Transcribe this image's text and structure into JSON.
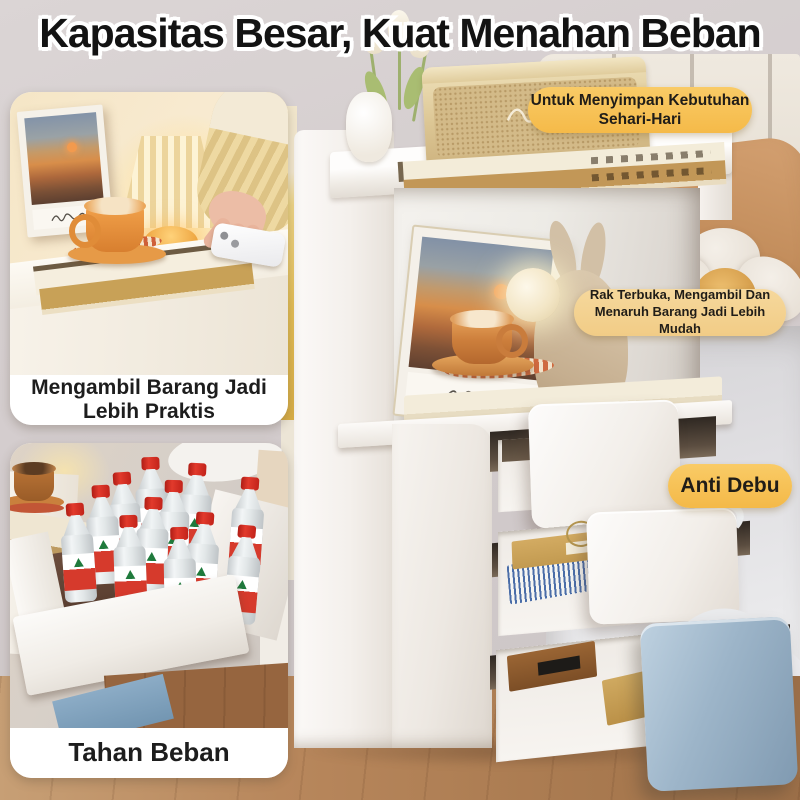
{
  "title": "Kapasitas Besar, Kuat Menahan Beban",
  "badges": {
    "daily": {
      "line1": "Untuk Menyimpan Kebutuhan",
      "line2": "Sehari-Hari"
    },
    "open_shelf": {
      "line1": "Rak Terbuka, Mengambil Dan",
      "line2": "Menaruh Barang Jadi Lebih Mudah"
    },
    "anti_dust": {
      "label": "Anti Debu"
    }
  },
  "cards": {
    "practical": {
      "line1": "Mengambil Barang Jadi",
      "line2": "Lebih Praktis"
    },
    "load_bearing": {
      "label": "Tahan Beban"
    }
  },
  "colors": {
    "badge_gold": "#f7c55a",
    "badge_light_yellow": "#f5d494",
    "caption_background": "#ffffff",
    "text_dark": "#1d1d1d",
    "drawer_blue": "#8fa9bf",
    "bottle_cap_red": "#d5281e",
    "wood_floor": "#b8875c"
  }
}
